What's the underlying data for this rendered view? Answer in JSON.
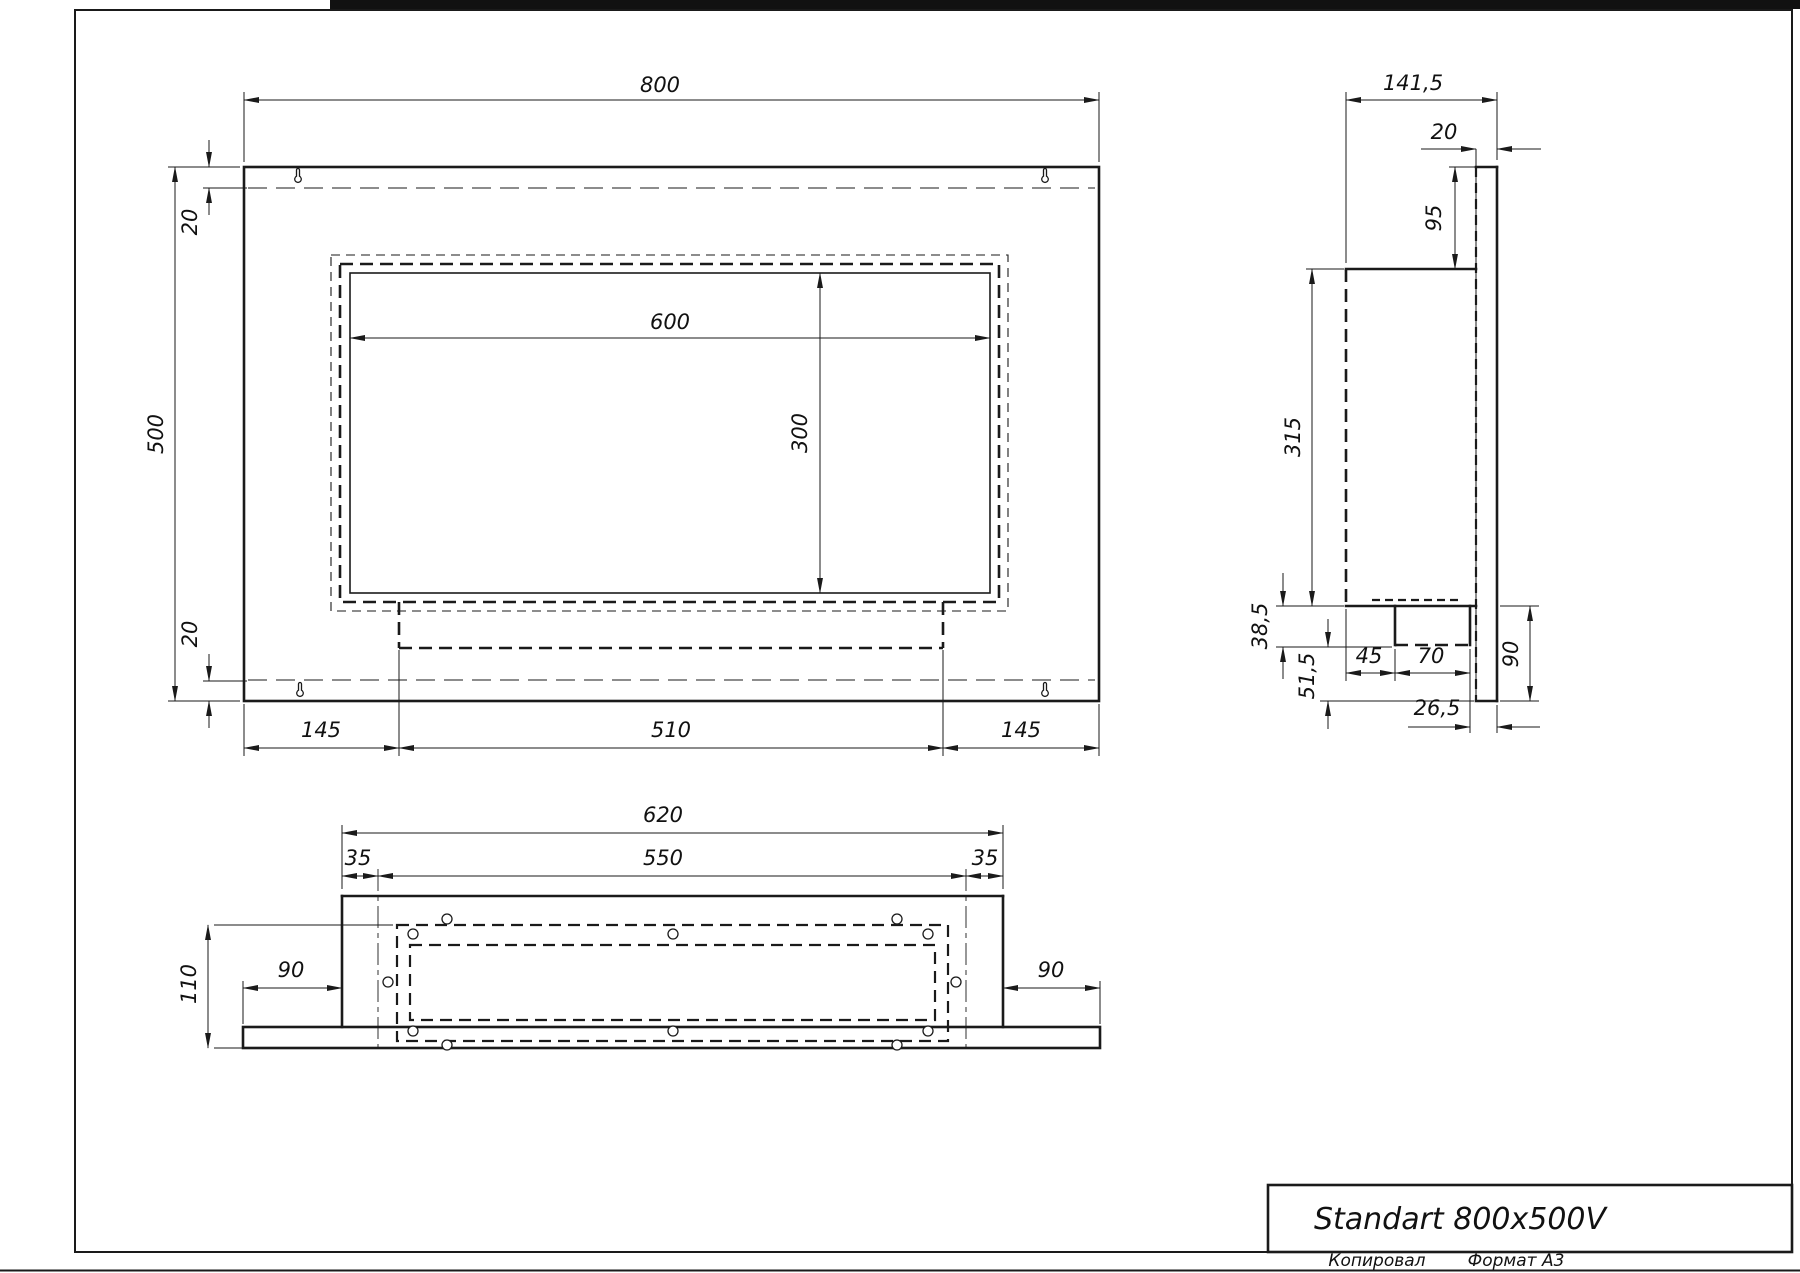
{
  "title_block": {
    "title": "Standart 800x500V",
    "copied": "Копировал",
    "format": "Формат А3"
  },
  "front_view": {
    "dims": {
      "width": "800",
      "height": "500",
      "top_offset": "20",
      "bottom_offset": "20",
      "opening_width": "600",
      "opening_height": "300",
      "left_margin": "145",
      "burner_width": "510",
      "right_margin": "145"
    }
  },
  "side_view": {
    "dims": {
      "depth": "141,5",
      "plate_thickness": "20",
      "plate_top_to_body": "95",
      "body_height": "315",
      "tray_drop": "38,5",
      "tray_to_plate_bottom": "51,5",
      "tray_front_offset": "45",
      "tray_width": "70",
      "tray_back_gap": "26,5",
      "plate_below_body": "90"
    }
  },
  "bottom_view": {
    "dims": {
      "body_width": "620",
      "flange_width": "550",
      "left_inset": "35",
      "right_inset": "35",
      "depth": "110",
      "plate_left_ext": "90",
      "plate_right_ext": "90"
    }
  }
}
